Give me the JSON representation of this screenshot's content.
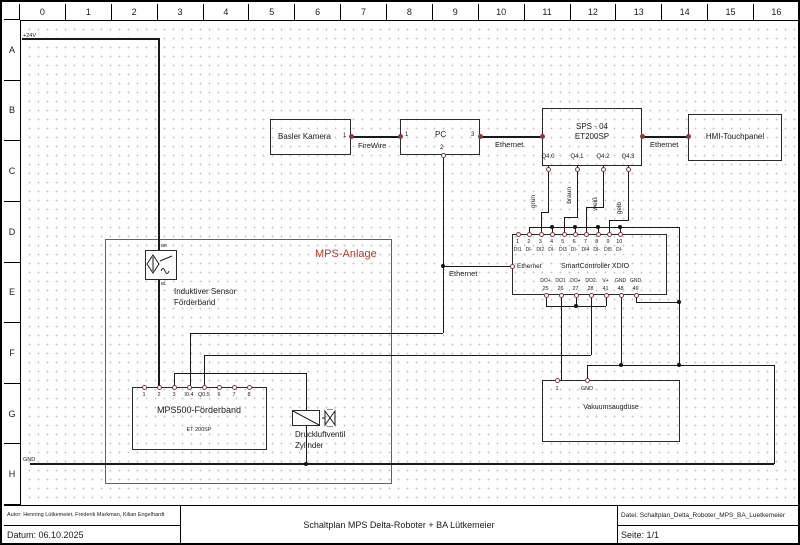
{
  "grid": {
    "columns": [
      "0",
      "1",
      "2",
      "3",
      "4",
      "5",
      "6",
      "7",
      "8",
      "9",
      "10",
      "11",
      "12",
      "13",
      "14",
      "15",
      "16"
    ],
    "rows": [
      "A",
      "B",
      "C",
      "D",
      "E",
      "F",
      "G",
      "H"
    ]
  },
  "power": {
    "v24": "+24V",
    "gnd": "GND"
  },
  "labels": {
    "firewire": "FireWire",
    "ethernet_pc": "Ethernet",
    "ethernet_hmi": "Ethernet",
    "ethernet_xdio": "Ethernet",
    "mps_anlage": "MPS-Anlage",
    "sensor_line1": "Induktiver Sensor",
    "sensor_line2": "Förderband",
    "sensor_pin_top": "BR",
    "sensor_pin_bottom": "BL",
    "valve_line1": "Druckluftventil",
    "valve_line2": "Zylinder",
    "wire_colors": [
      "grün",
      "braun",
      "weiß",
      "gelb"
    ]
  },
  "kamera": {
    "label": "Basler Kamera",
    "pin_right": "1"
  },
  "pc": {
    "label": "PC",
    "pin_left": "1",
    "pin_right": "3",
    "pin_bottom": "2"
  },
  "sps": {
    "line1": "SPS - 04",
    "line2": "ET200SP",
    "q_pins": [
      "Q4.0",
      "Q4.1",
      "Q4.2",
      "Q4.3"
    ]
  },
  "hmi": {
    "label": "HMI-Touchpanel"
  },
  "xdio": {
    "title": "SmartController XDIO",
    "eth_label": "Ethernet",
    "top_numbers": [
      "1",
      "2",
      "3",
      "4",
      "5",
      "6",
      "7",
      "8",
      "9",
      "10"
    ],
    "top_labels": [
      "DI1",
      "DI-",
      "DI2",
      "DI-",
      "DI3",
      "DI-",
      "DI4",
      "DI-",
      "DI5",
      "DI-"
    ],
    "bottom_labels": [
      "DO+",
      "DO1",
      "DO+",
      "DO2",
      "V+",
      "GND",
      "GND"
    ],
    "bottom_numbers": [
      "25",
      "26",
      "27",
      "28",
      "41",
      "48",
      "49"
    ]
  },
  "vakuum": {
    "label": "Vakuumsaugdüse",
    "pin1": "1",
    "pin2": "GND"
  },
  "mps500": {
    "label": "MPS500-Förderband",
    "sub": "ET 200SP",
    "pins": [
      "1",
      "2",
      "3",
      "I0.4",
      "Q0.5",
      "6",
      "7",
      "8"
    ]
  },
  "titleblock": {
    "autor": "Autor: Henning Lütkemeier, Frederik Markman, Kilian Engelhardt",
    "datum": "Datum: 06.10.2025",
    "title": "Schaltplan MPS Delta-Roboter + BA Lütkemeier",
    "datei": "Datei: Schaltplan_Delta_Roboter_MPS_BA_Luetkemeier",
    "seite": "Seite: 1/1"
  },
  "colors": {
    "accent_red": "#b04040",
    "wire": "#1a1a1a",
    "pin_ring": "#8b3a3a"
  }
}
